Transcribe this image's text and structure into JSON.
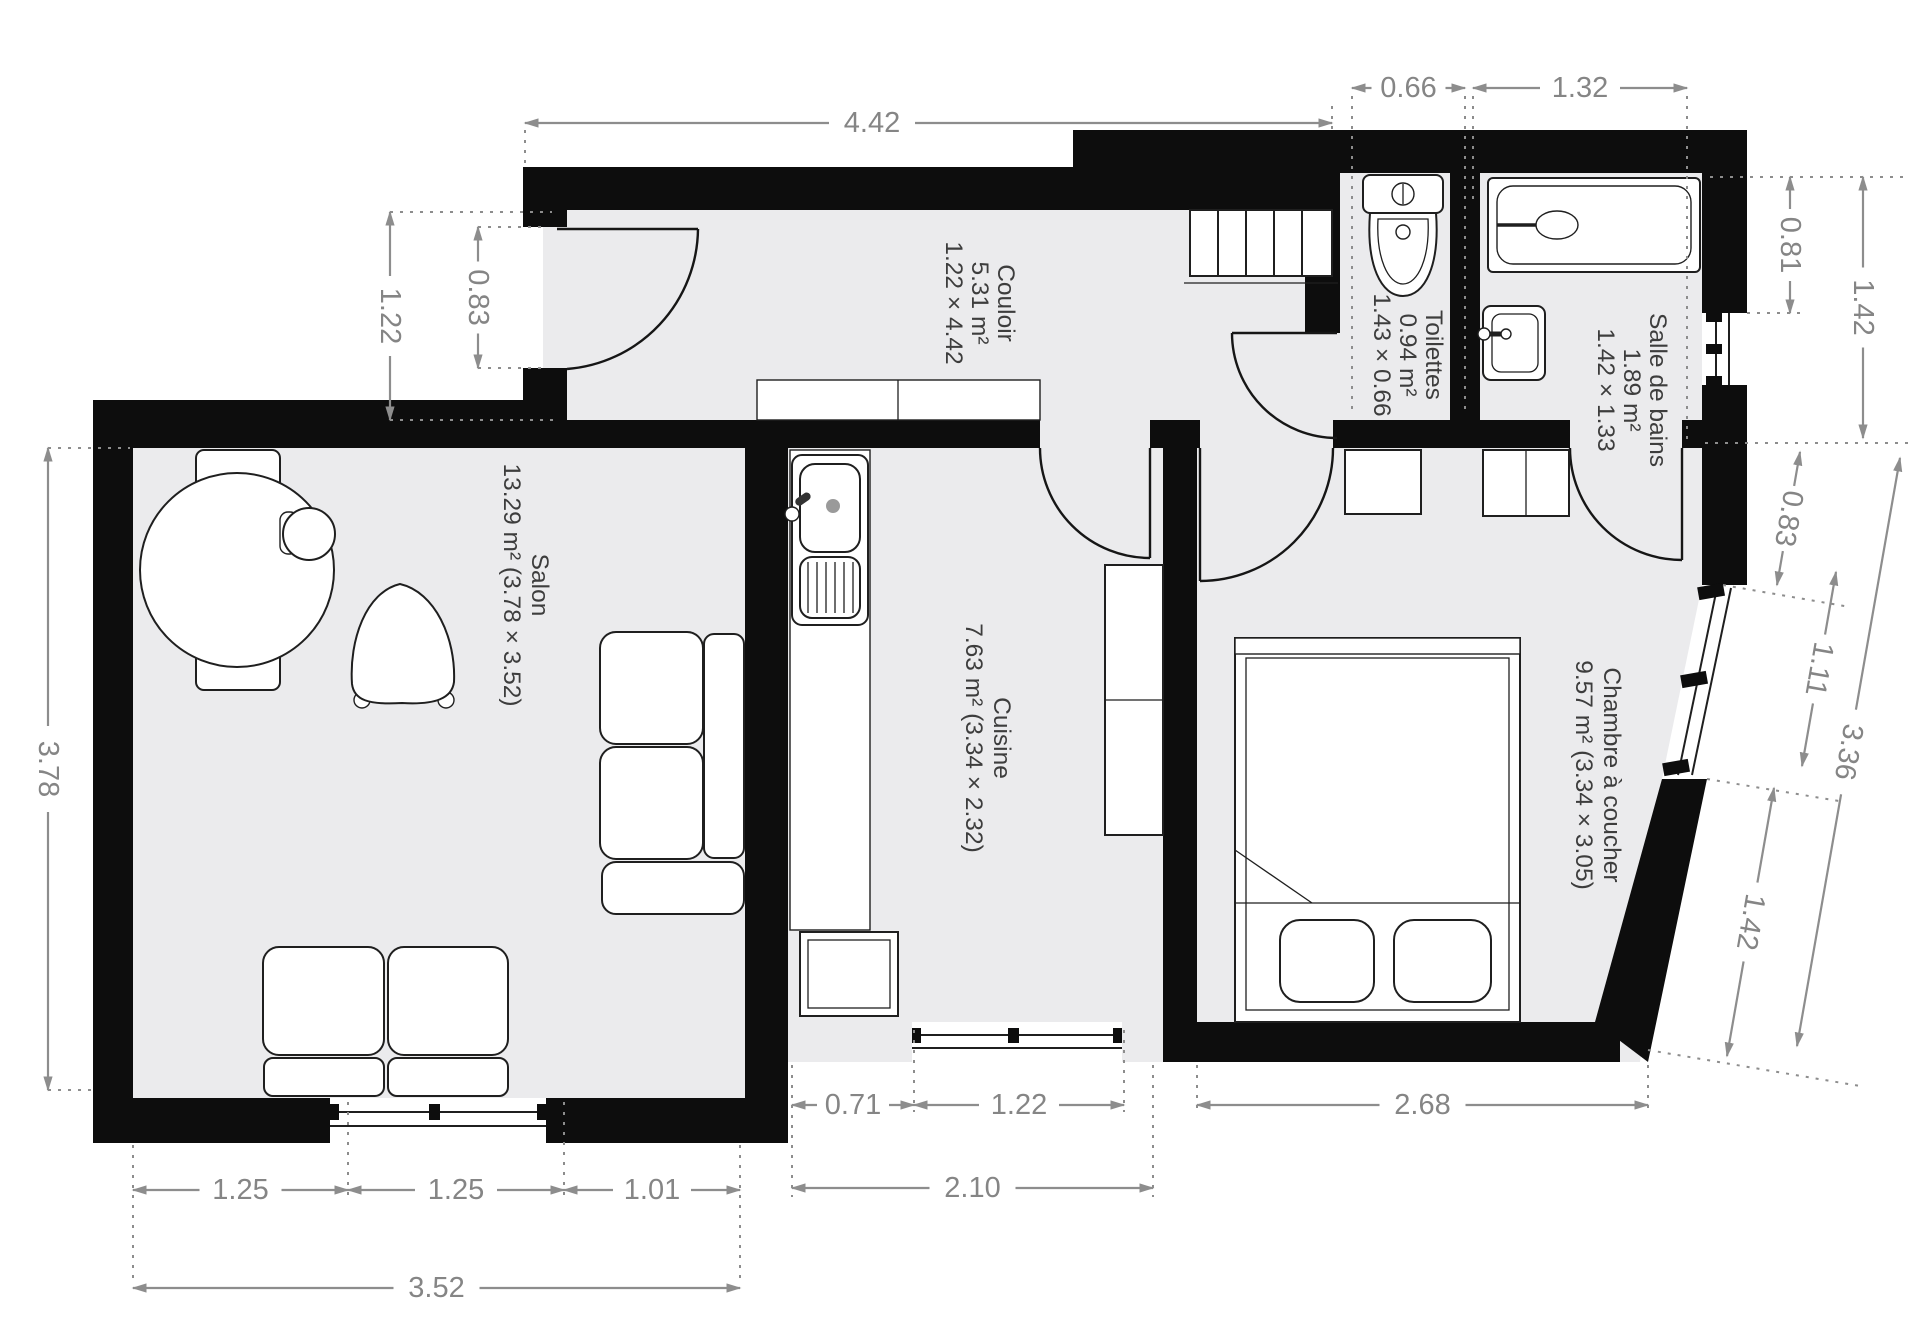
{
  "rooms": {
    "salon": {
      "name": "Salon",
      "details": "13.29 m² (3.78 × 3.52)"
    },
    "couloir": {
      "name": "Couloir",
      "area": "5.31 m²",
      "dims": "1.22 × 4.42"
    },
    "cuisine": {
      "name": "Cuisine",
      "details": "7.63 m² (3.34 × 2.32)"
    },
    "toilettes": {
      "name": "Toilettes",
      "area": "0.94 m²",
      "dims": "1.43 × 0.66"
    },
    "salle_de_bains": {
      "name": "Salle de bains",
      "area": "1.89 m²",
      "dims": "1.42 × 1.33"
    },
    "chambre": {
      "name": "Chambre à coucher",
      "details": "9.57 m² (3.34 × 3.05)"
    }
  },
  "dimensions": {
    "top": [
      "4.42",
      "0.66",
      "1.32"
    ],
    "left": [
      "1.22",
      "0.83",
      "3.78"
    ],
    "right": [
      "0.81",
      "1.42",
      "0.83",
      "1.11",
      "3.36",
      "1.42"
    ],
    "bottom": [
      "0.71",
      "1.22",
      "2.10",
      "2.68",
      "1.25",
      "1.25",
      "1.01",
      "3.52"
    ]
  },
  "colors": {
    "wall": "#0d0d0d",
    "floor": "#ebebed",
    "dimension_gray": "#8d8d8d",
    "label_gray": "#3d3d3d"
  }
}
